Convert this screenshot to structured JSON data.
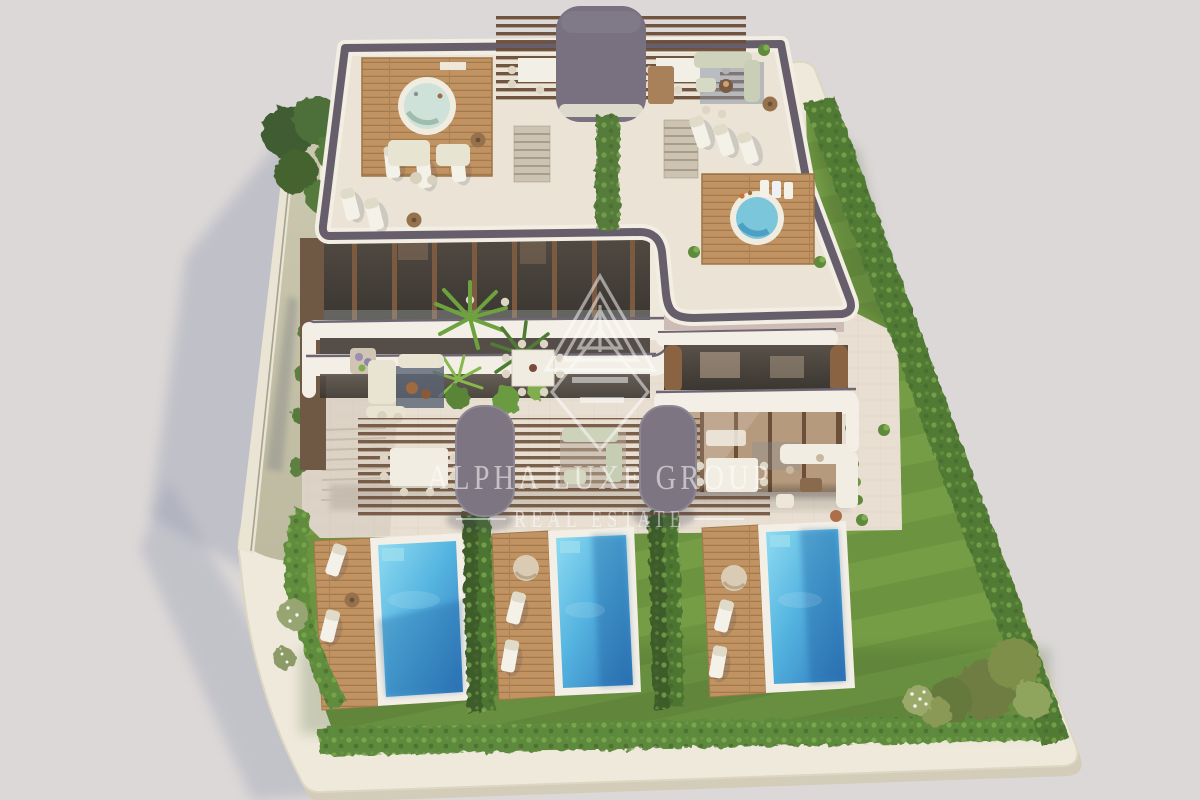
{
  "scene": {
    "type": "aerial-3d-architectural-render",
    "subject": "Modern luxury villa complex with rooftop terraces, two jacuzzis, pergolas, landscaped striped lawns, boundary hedges and three private pools with wooden sun decks",
    "palette": {
      "background": "#dcd8d7",
      "plot_base": "#efe9db",
      "paving": "#e8dfd2",
      "gravel_path": "#c6c3a9",
      "boundary_wall": "#eae4d4",
      "lawn": "#6e9542",
      "lawn_stripe": "#7da74b",
      "hedge": "#5d8a3c",
      "hedge_dark": "#3c5c2a",
      "pool_water_light": "#7fd4ee",
      "pool_water_deep": "#2f78bc",
      "pool_coping": "#f3efe6",
      "deck_wood": "#c19362",
      "pergola_slats": "#6b4d37",
      "roof_floor": "#ebe4d6",
      "parapet": "#665f6b",
      "slab_band": "#f3efe6",
      "canopy_gray": "#7d7582",
      "facade_glass": "#4a443e",
      "facade_wood": "#8a6342",
      "shadow": "#9aa0b4"
    }
  },
  "watermark": {
    "brand": "Alpha Luxe Group",
    "line1": "ALPHA LUXE GROUP",
    "line2": "REAL ESTATE",
    "logo": "alpha-triangle-monogram",
    "color": "#ffffff"
  }
}
